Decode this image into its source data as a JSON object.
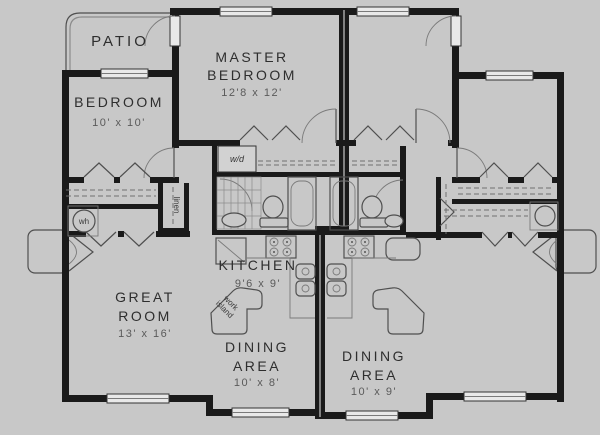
{
  "colors": {
    "background": "#c8c8c8",
    "wall": "#1a1a1a",
    "room_text": "#2e2e2e",
    "dim_text": "#5a5a5a",
    "window_fill": "#e9e9e9"
  },
  "rooms": {
    "patio": {
      "name": "PATIO"
    },
    "master_bedroom": {
      "line1": "MASTER",
      "line2": "BEDROOM",
      "dims": "12'8 x 12'"
    },
    "bedroom": {
      "name": "BEDROOM",
      "dims": "10' x 10'"
    },
    "great_room": {
      "line1": "GREAT",
      "line2": "ROOM",
      "dims": "13' x 16'"
    },
    "kitchen": {
      "name": "KITCHEN",
      "dims": "9'6 x 9'"
    },
    "dining_left": {
      "line1": "DINING",
      "line2": "AREA",
      "dims": "10' x 8'"
    },
    "dining_right": {
      "line1": "DINING",
      "line2": "AREA",
      "dims": "10' x 9'"
    }
  },
  "fixtures": {
    "washer_dryer": "w/d",
    "water_heater": "wh",
    "linen_closet": "linen",
    "island_line1": "work",
    "island_line2": "island"
  }
}
